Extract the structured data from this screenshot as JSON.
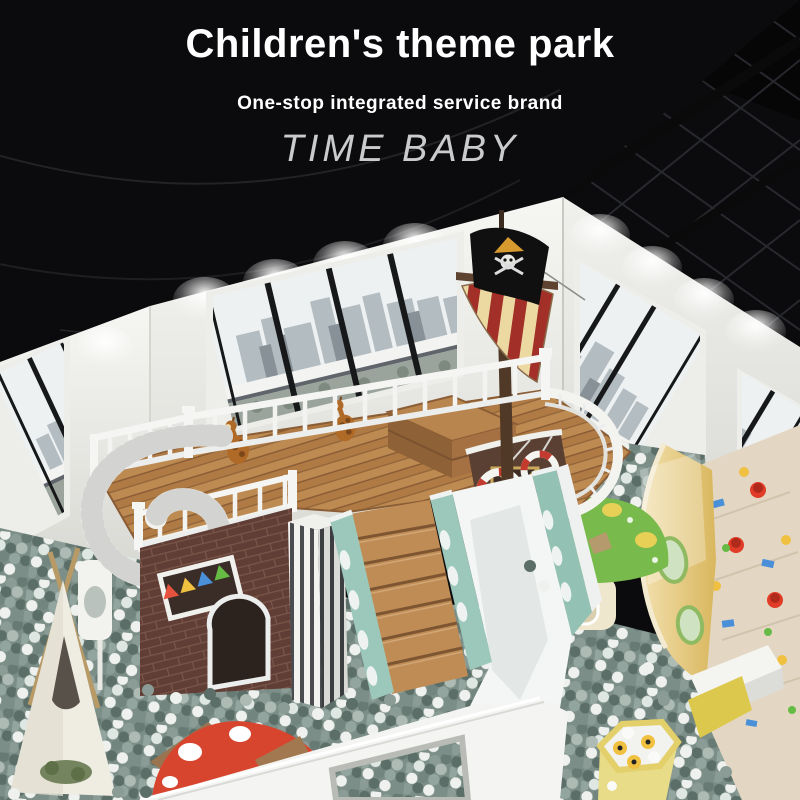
{
  "overlay": {
    "title": "Children's theme park",
    "subtitle": "One-stop integrated service brand",
    "brand": "TIME BABY"
  },
  "palette": {
    "ceiling": "#0b0b0d",
    "wall": "#e9e9e5",
    "window_sky": "#eef1f2",
    "deck_wood": "#b5824c",
    "sail_red": "#a22f28",
    "sail_cream": "#ecd9a2",
    "ball_dark": "#5c6e68",
    "ball_mid": "#8a9c95",
    "ball_white": "#eef1ee",
    "slide_mint": "#9cc8bb",
    "slide_white": "#f4f6f5",
    "counter_yellow": "#e5c87c",
    "mushroom_red": "#d8452f",
    "mushroom_green": "#79ba4c",
    "house_brick": "#5f3c34"
  },
  "scene": {
    "objects": [
      "pirate-ship-deck",
      "striped-sail",
      "pirate-flag",
      "ball-pit",
      "spiral-slide",
      "wide-slide",
      "wooden-stairs",
      "brick-playhouse",
      "teepee-tent",
      "red-mushroom",
      "green-mushroom-house",
      "sand-play-counter",
      "hexagon-play-table",
      "giraffe-plush",
      "city-view-windows",
      "striped-column",
      "life-rings"
    ]
  }
}
